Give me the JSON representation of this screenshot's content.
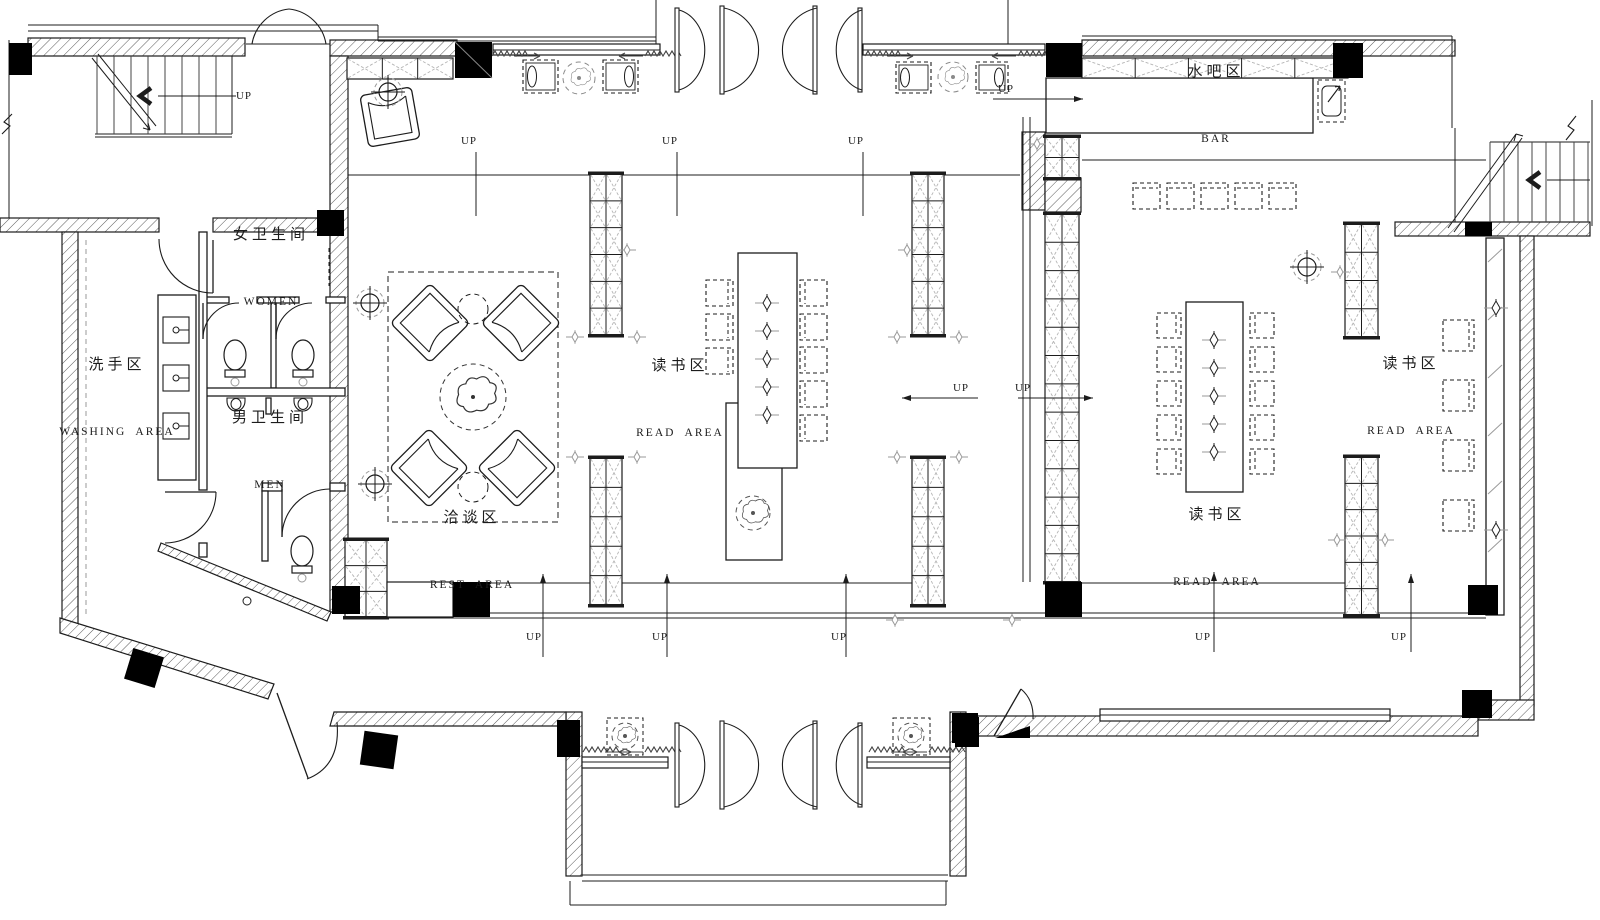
{
  "plan": {
    "title": "floor-plan",
    "colors": {
      "ink": "#1c1c1c",
      "gray": "#9a9a9a",
      "hatch": "#5a5a5a",
      "column": "#000000",
      "paper": "#ffffff"
    },
    "areas": {
      "bar": {
        "zh": "水吧区",
        "en": "BAR"
      },
      "women": {
        "zh": "女卫生间",
        "en": "WOMEN"
      },
      "washing": {
        "zh": "洗手区",
        "en": "WASHING  AREA"
      },
      "men": {
        "zh": "男卫生间",
        "en": "MEN"
      },
      "rest": {
        "zh": "洽谈区",
        "en": "REST  AREA"
      },
      "read_center": {
        "zh": "读书区",
        "en": "READ  AREA"
      },
      "read_right": {
        "zh": "读书区",
        "en": "READ  AREA"
      },
      "read_window": {
        "zh": "读书区",
        "en": "READ  AREA"
      }
    },
    "markers": {
      "up": "UP"
    }
  }
}
